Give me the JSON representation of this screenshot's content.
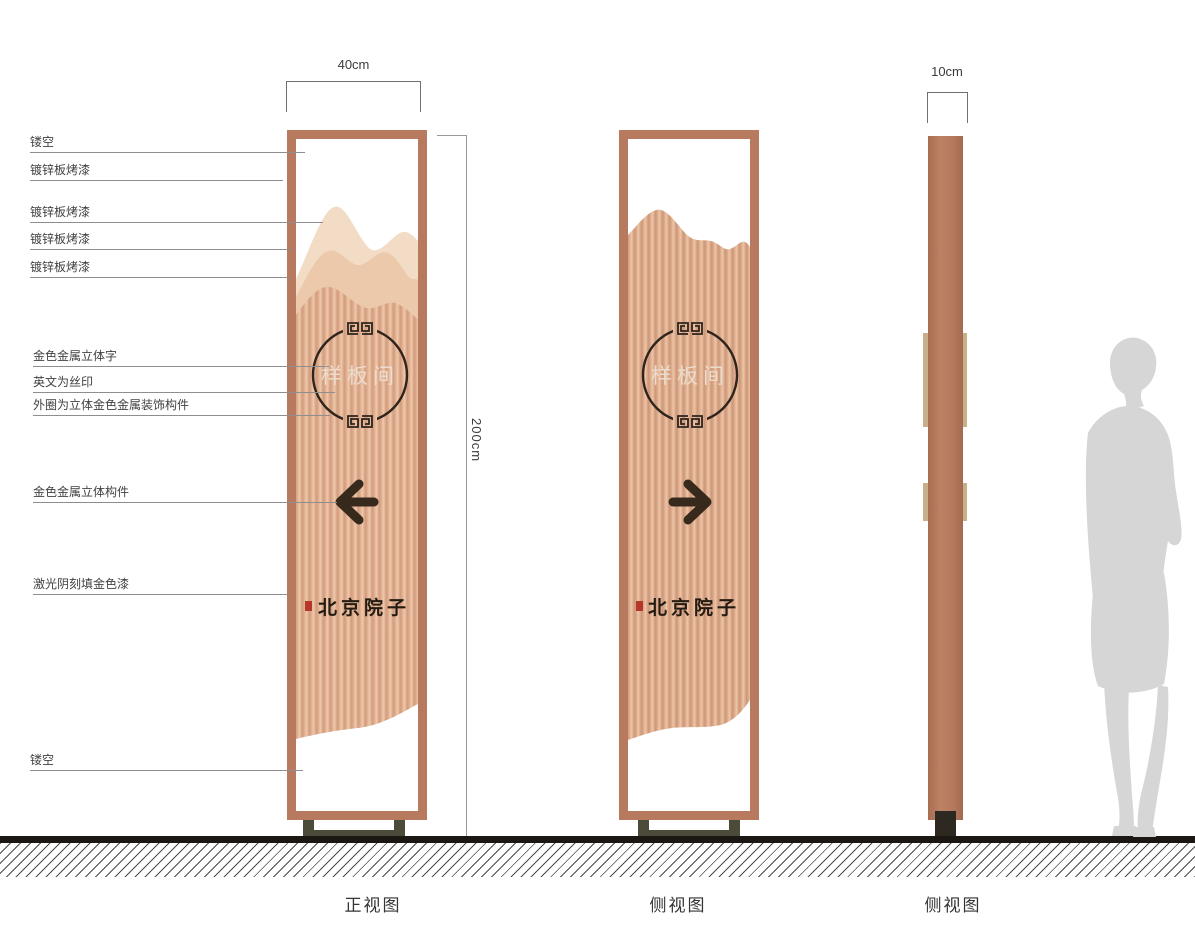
{
  "dimensions": {
    "front_width": "40cm",
    "height": "200cm",
    "side_width": "10cm"
  },
  "annotations": [
    "镂空",
    "镀锌板烤漆",
    "镀锌板烤漆",
    "镀锌板烤漆",
    "镀锌板烤漆",
    "金色金属立体字",
    "英文为丝印",
    "外圈为立体金色金属装饰构件",
    "金色金属立体构件",
    "激光阴刻填金色漆",
    "镂空"
  ],
  "sign": {
    "plate_text": "样板间",
    "logo_text": "北京院子"
  },
  "captions": [
    "正视图",
    "侧视图",
    "侧视图"
  ],
  "colors": {
    "frame": "#b87a5e",
    "panel_base": "#dcab8e",
    "panel_light": "#eecaad",
    "panel_dark": "#d29b7d",
    "mountain_back": "#f3dcc5",
    "mountain_mid": "#ecc9ab",
    "ornament_dark": "#2e241c",
    "logo_dark": "#241b12",
    "seal_red": "#b5372a",
    "base_olive": "#4c4a39",
    "ground_black": "#1b1713",
    "side_tab_tan": "#c9ae8c",
    "silhouette_gray": "#d6d6d6"
  }
}
